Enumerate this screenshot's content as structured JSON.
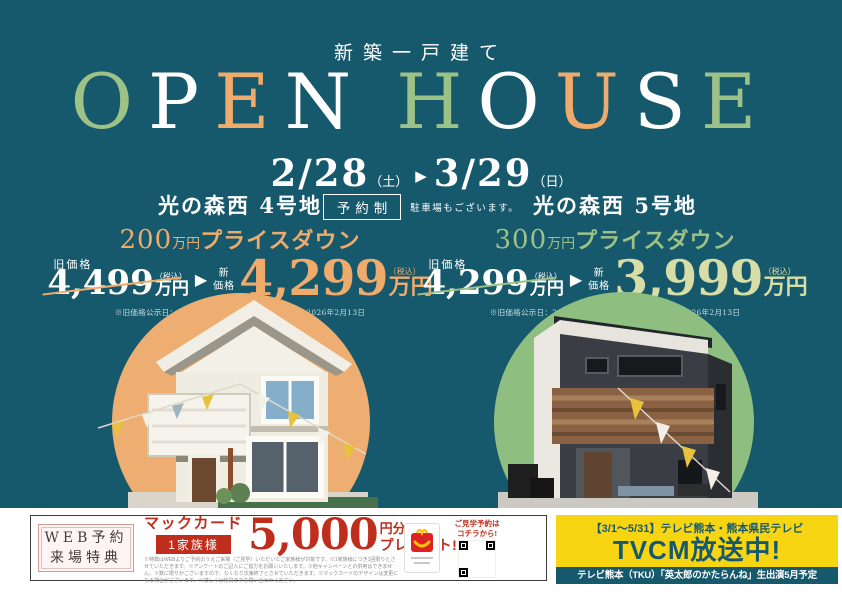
{
  "header": {
    "subtitle": "新築一戸建て",
    "title": [
      {
        "ch": "O"
      },
      {
        "ch": "P"
      },
      {
        "ch": "E"
      },
      {
        "ch": "N"
      },
      {
        "ch": "H"
      },
      {
        "ch": "O"
      },
      {
        "ch": "U"
      },
      {
        "ch": "S"
      },
      {
        "ch": "E"
      }
    ],
    "date_start": "2/28",
    "date_start_day": "（土）",
    "date_end": "3/29",
    "date_end_day": "（日）",
    "reservation_badge": "予約制",
    "parking_note": "駐車場もございます。"
  },
  "icons": {
    "arrow": "▶"
  },
  "properties": [
    {
      "name": "光の森西 4号地",
      "pricedown_value": "200",
      "pricedown_unit": "万円",
      "pricedown_text": "プライスダウン",
      "old_label": "旧価格",
      "old_value": "4,499",
      "tax": "（税込）",
      "unit": "万円",
      "new_label_1": "新",
      "new_label_2": "価格",
      "new_value": "4,299",
      "note": "※旧価格公示日：2025年5月30日　※新価格公示日：2026年2月13日",
      "accent_color": "#efab6b"
    },
    {
      "name": "光の森西 5号地",
      "pricedown_value": "300",
      "pricedown_unit": "万円",
      "pricedown_text": "プライスダウン",
      "old_label": "旧価格",
      "old_value": "4,299",
      "tax": "（税込）",
      "unit": "万円",
      "new_label_1": "新",
      "new_label_2": "価格",
      "new_value": "3,999",
      "note": "※旧価格公示日：2025年5月30日　※新価格公示日：2026年2月13日",
      "accent_color": "#9cc287",
      "new_price_color": "#d6dda6"
    }
  ],
  "footer": {
    "web_badge_line1": "WEB予約",
    "web_badge_line2": "来場特典",
    "gift_brand": "マックカード",
    "gift_per": "1家族様",
    "gift_amount": "5,000",
    "gift_unit": "円分",
    "gift_present": "プレゼント!",
    "fine_print": "※特典はWEBよりご予約のうえご来場（ご見学）いただいたご家族様が対象です。※1家族様につき1回限りとさせていただきます。※アンケートのご記入にご協力をお願いいたします。※他キャンペーンとの併用はできません。※数に限りがございますので、なくなり次第終了とさせていただきます。※マックカードのデザインは変更になる場合がございます。※詳しくは係員までお問い合わせください。",
    "qr_label_line1": "ご見学予約は",
    "qr_label_line2": "コチラから!",
    "tvcm_schedule": "【3/1～5/31】テレビ熊本・熊本県民テレビ",
    "tvcm_title": "TVCM放送中!",
    "tvcm_program": "テレビ熊本（TKU）「英太郎のかたらんね」生出演5月予定"
  },
  "colors": {
    "background_teal": "#17596c",
    "accent_orange": "#efab6b",
    "accent_green": "#9cc287",
    "pale_green_price": "#d6dda6",
    "circle_left": "#eeae71",
    "circle_right": "#8fbe81",
    "promo_red": "#bf2e1c",
    "tvcm_yellow": "#f8d513",
    "white": "#ffffff"
  }
}
